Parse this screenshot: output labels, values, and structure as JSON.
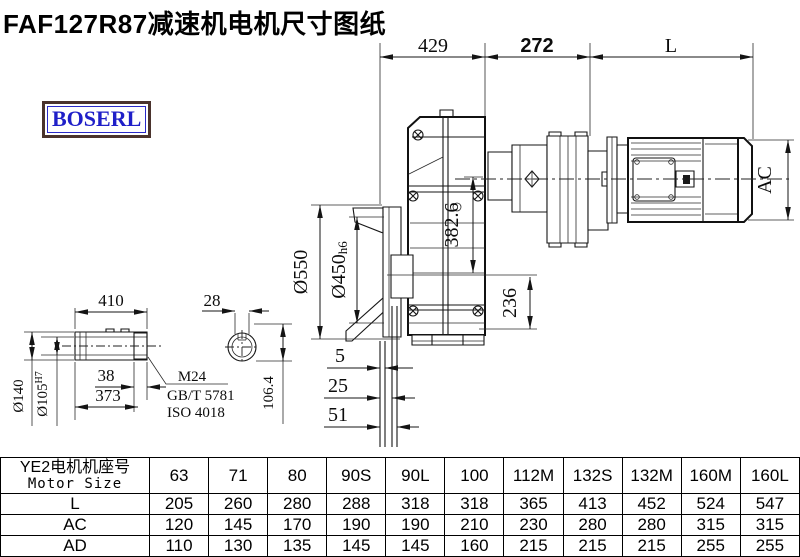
{
  "title": "FAF127R87减速机电机尺寸图纸",
  "logo": {
    "text": "BOSERL",
    "text_color": "#1f1fc8",
    "border_color": "#4a332d",
    "inner_border_color": "#2a2ac8"
  },
  "drawing": {
    "top_dims": {
      "d429": "429",
      "d272": "272",
      "dL": "L"
    },
    "left_dims": {
      "d550": "Ø550",
      "d450": "Ø450",
      "d450_suffix": "h6",
      "d382": "382.6",
      "d236": "236"
    },
    "right_dims": {
      "ac": "AC"
    },
    "bottom_dims": {
      "d5": "5",
      "d25": "25",
      "d51": "51"
    },
    "shaft_inset": {
      "d410": "410",
      "d28": "28",
      "d140": "Ø140",
      "d105": "Ø105",
      "d105_sup": "H7",
      "d38": "38",
      "d373": "373",
      "m24": "M24",
      "gbt": "GB/T 5781",
      "iso": "ISO 4018",
      "d1064": "106.4"
    }
  },
  "table": {
    "header_cn": "YE2电机机座号",
    "header_en": "Motor Size",
    "columns": [
      "63",
      "71",
      "80",
      "90S",
      "90L",
      "100",
      "112M",
      "132S",
      "132M",
      "160M",
      "160L"
    ],
    "rows": [
      {
        "label": "L",
        "values": [
          "205",
          "260",
          "280",
          "288",
          "318",
          "318",
          "365",
          "413",
          "452",
          "524",
          "547"
        ]
      },
      {
        "label": "AC",
        "values": [
          "120",
          "145",
          "170",
          "190",
          "190",
          "210",
          "230",
          "280",
          "280",
          "315",
          "315"
        ]
      },
      {
        "label": "AD",
        "values": [
          "110",
          "130",
          "135",
          "145",
          "145",
          "160",
          "215",
          "215",
          "215",
          "255",
          "255"
        ]
      }
    ]
  }
}
